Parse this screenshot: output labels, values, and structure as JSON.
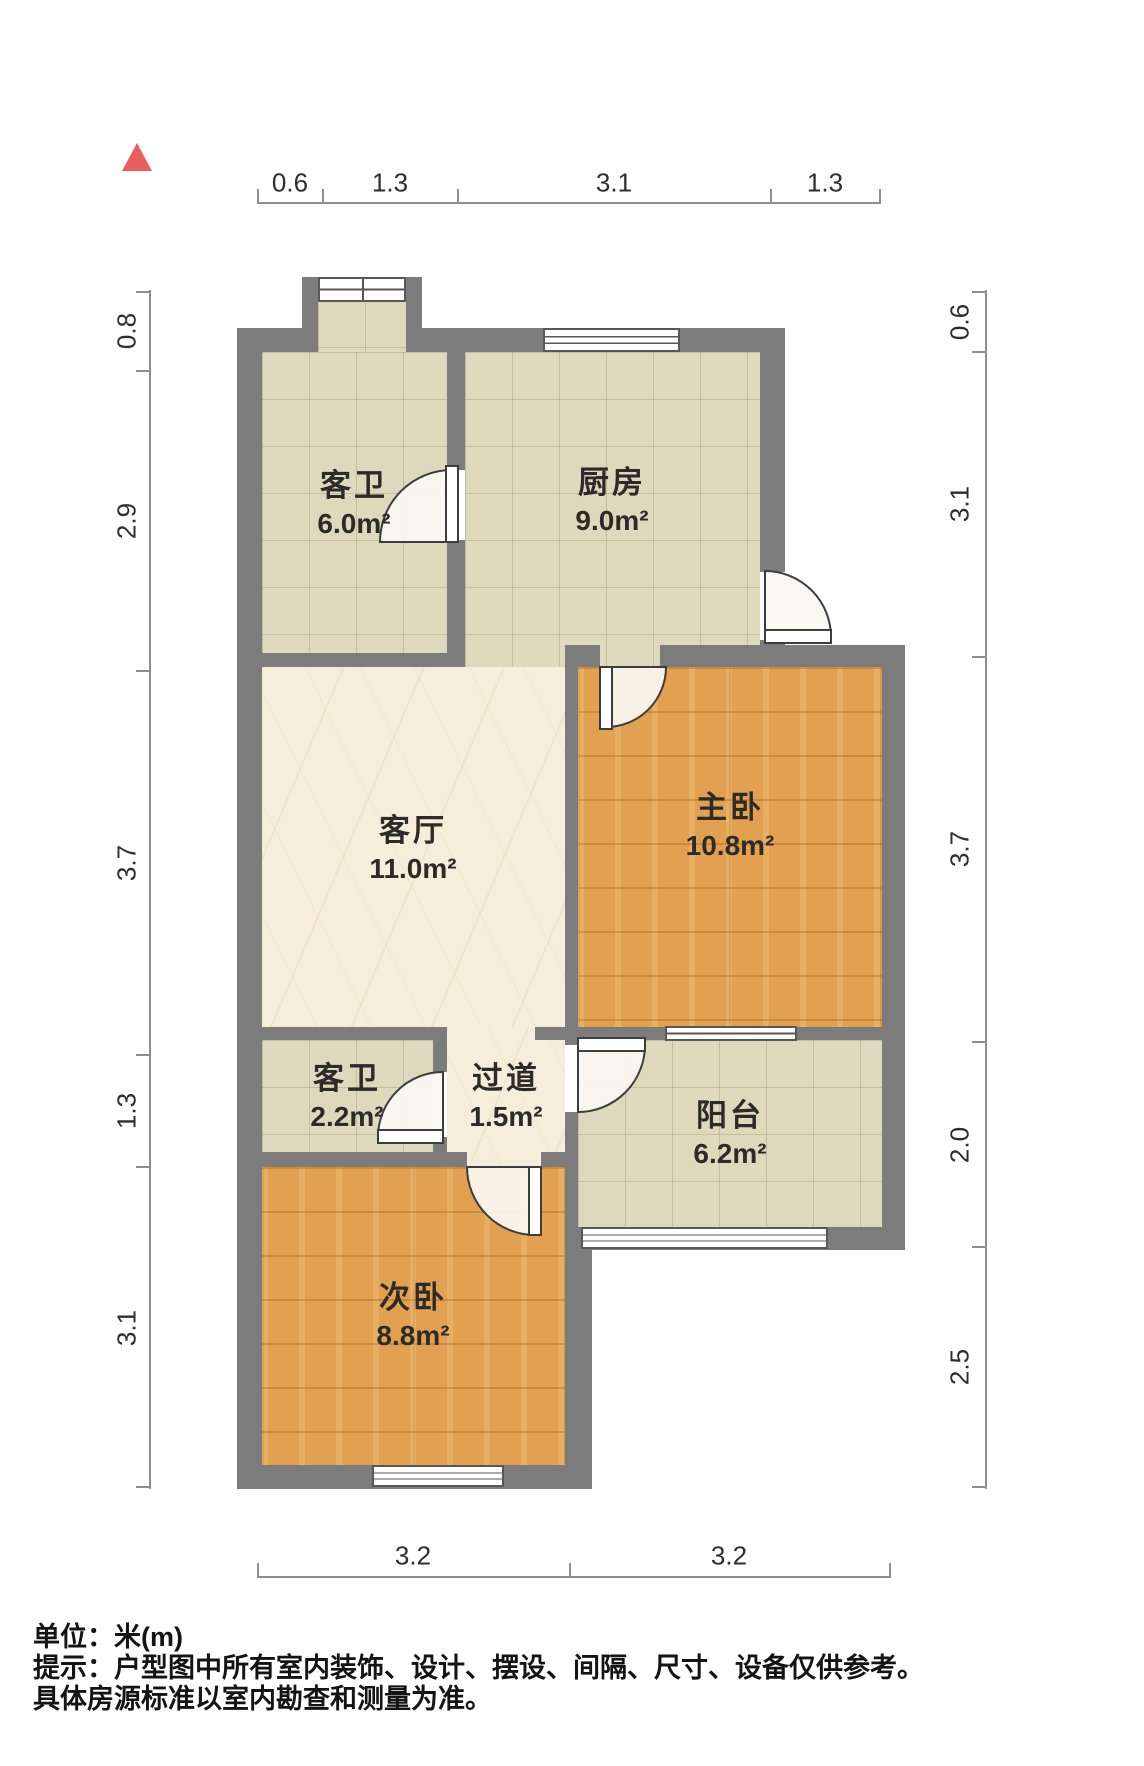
{
  "plan_title": "户型图",
  "north_indicator": {
    "type": "triangle"
  },
  "rooms": {
    "guest_bathroom_1": {
      "name": "客卫",
      "area": "6.0m²",
      "floor": "tile"
    },
    "kitchen": {
      "name": "厨房",
      "area": "9.0m²",
      "floor": "tile"
    },
    "living_room": {
      "name": "客厅",
      "area": "11.0m²",
      "floor": "marble"
    },
    "master_bedroom": {
      "name": "主卧",
      "area": "10.8m²",
      "floor": "wood"
    },
    "guest_bathroom_2": {
      "name": "客卫",
      "area": "2.2m²",
      "floor": "tile"
    },
    "hallway": {
      "name": "过道",
      "area": "1.5m²",
      "floor": "marble"
    },
    "balcony": {
      "name": "阳台",
      "area": "6.2m²",
      "floor": "tile"
    },
    "second_bedroom": {
      "name": "次卧",
      "area": "8.8m²",
      "floor": "wood"
    }
  },
  "dimensions": {
    "unit": "米(m)",
    "top": [
      "0.6",
      "1.3",
      "3.1",
      "1.3"
    ],
    "left": [
      "0.8",
      "2.9",
      "3.7",
      "1.3",
      "3.1"
    ],
    "right": [
      "0.6",
      "3.1",
      "3.7",
      "2.0",
      "2.5"
    ],
    "bottom": [
      "3.2",
      "3.2"
    ]
  },
  "footer": {
    "unit_line": "单位：米(m)",
    "note_line_1": "提示：户型图中所有室内装饰、设计、摆设、间隔、尺寸、设备仅供参考。",
    "note_line_2": "具体房源标准以室内勘查和测量为准。"
  },
  "colors": {
    "wall": "#7c7c7c",
    "tile_floor": "#ded9bd",
    "marble_floor": "#f6eedb",
    "wood_floor": "#e1a150",
    "north_arrow": "#e85f5f",
    "dimension_line": "#8f8f8f",
    "label_text": "#2d2b28"
  }
}
